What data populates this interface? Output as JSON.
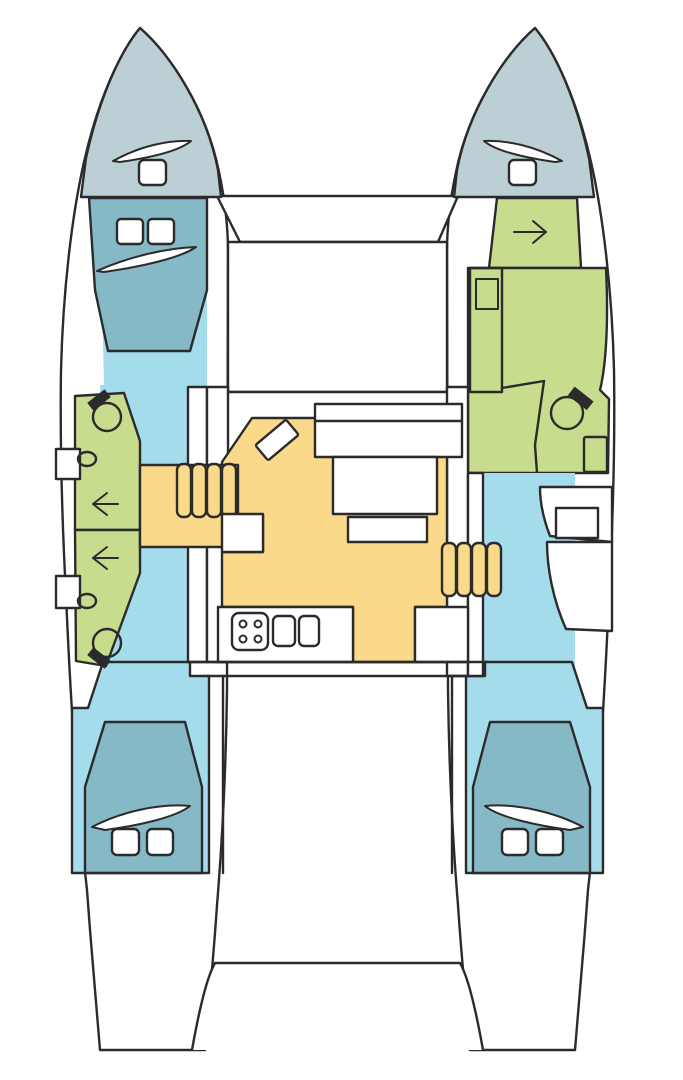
{
  "page": {
    "background": "#ffffff"
  },
  "diagram": {
    "type": "boat-floor-plan",
    "vessel": "catamaran",
    "view": "top-down interior layout",
    "title": "Catamaran interior floor plan (top view)",
    "colors": {
      "outline": "#2b2b2b",
      "hull_white": "#ffffff",
      "forepeak_gray": "#bccfd4",
      "berth_teal": "#85b9c6",
      "corridor_blue": "#a4dcec",
      "bathroom_green": "#c8dc8e",
      "salon_orange": "#fad98a"
    },
    "regions": [
      {
        "name": "port-forepeak",
        "color_key": "forepeak_gray"
      },
      {
        "name": "starboard-forepeak",
        "color_key": "forepeak_gray"
      },
      {
        "name": "port-forward-cabin-berth",
        "color_key": "berth_teal"
      },
      {
        "name": "port-aft-cabin-berth",
        "color_key": "berth_teal"
      },
      {
        "name": "starboard-aft-cabin-berth",
        "color_key": "berth_teal"
      },
      {
        "name": "port-hull-corridor",
        "color_key": "corridor_blue"
      },
      {
        "name": "starboard-hull-corridor",
        "color_key": "corridor_blue"
      },
      {
        "name": "port-forward-head",
        "color_key": "bathroom_green"
      },
      {
        "name": "port-aft-head",
        "color_key": "bathroom_green"
      },
      {
        "name": "starboard-head-suite",
        "color_key": "bathroom_green"
      },
      {
        "name": "salon-and-galley",
        "color_key": "salon_orange"
      },
      {
        "name": "foredeck",
        "color_key": "hull_white"
      },
      {
        "name": "aft-platform",
        "color_key": "hull_white"
      }
    ],
    "icons": [
      "toilet-icon",
      "sink-icon",
      "shower-arrow-icon",
      "entry-arrow-icon",
      "stove-icon",
      "galley-sink-icon",
      "deck-hatch-icon",
      "berth-pillow",
      "berth-blanket",
      "companionway-steps"
    ]
  }
}
